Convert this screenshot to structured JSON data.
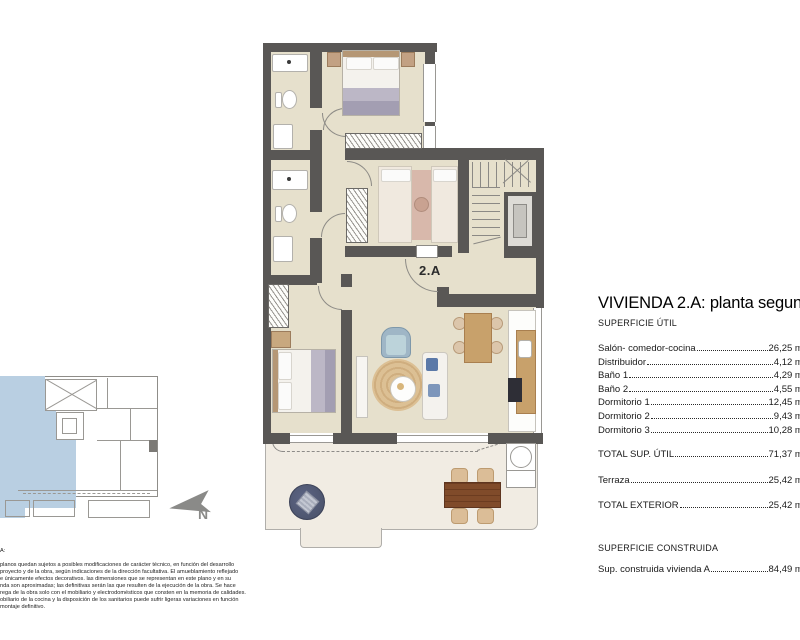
{
  "unit_label": "2.A",
  "north_label": "N",
  "panel": {
    "title": "VIVIENDA 2.A: planta segunda",
    "superficie_util_header": "SUPERFICIE ÚTIL",
    "rows": [
      {
        "label": "Salón- comedor-cocina",
        "value": "26,25 m²"
      },
      {
        "label": "Distribuidor",
        "value": "4,12 m²"
      },
      {
        "label": "Baño 1",
        "value": "4,29 m²"
      },
      {
        "label": "Baño 2",
        "value": "4,55 m²"
      },
      {
        "label": "Dormitorio 1",
        "value": "12,45 m²"
      },
      {
        "label": "Dormitorio 2",
        "value": "9,43 m²"
      },
      {
        "label": "Dormitorio 3",
        "value": "10,28 m²"
      }
    ],
    "total_util": {
      "label": "TOTAL SUP. ÚTIL",
      "value": "71,37 m²"
    },
    "terraza": {
      "label": "Terraza",
      "value": "25,42 m²"
    },
    "total_exterior": {
      "label": "TOTAL EXTERIOR",
      "value": "25,42 m²"
    },
    "superficie_construida_header": "SUPERFICIE CONSTRUIDA",
    "construida": {
      "label": "Sup. construida vivienda A",
      "value": "84,49 m²"
    }
  },
  "disclaimer": {
    "lines": [
      "A:",
      "planos quedan sujetos a posibles modificaciones de carácter técnico, en función del desarrollo",
      "proyecto y de la obra, según indicaciones de la dirección facultativa. El amueblamiento reflejado",
      "e únicamente efectos decorativos. las dimensiones que se representan en este plano y en su",
      "nda son aproximadas; las definitivas serán las que resulten de la ejecución de la obra. Se hace",
      "rega de la obra solo con el mobiliario y electrodomésticos que consten en la memoria de calidades.",
      "obiliario de la cocina y la disposición de los sanitarios puede sufrir ligeras variaciones en función",
      "montaje definitivo."
    ]
  },
  "colors": {
    "wall": "#595755",
    "floor": "#e6e0cc",
    "terrace": "#f1ece3",
    "highlight": "#b9cfe2",
    "wood": "#c8a16b",
    "outdoor-table": "#7a4526",
    "pouf": "#4e566f",
    "armchair": "#9fb6c6"
  }
}
